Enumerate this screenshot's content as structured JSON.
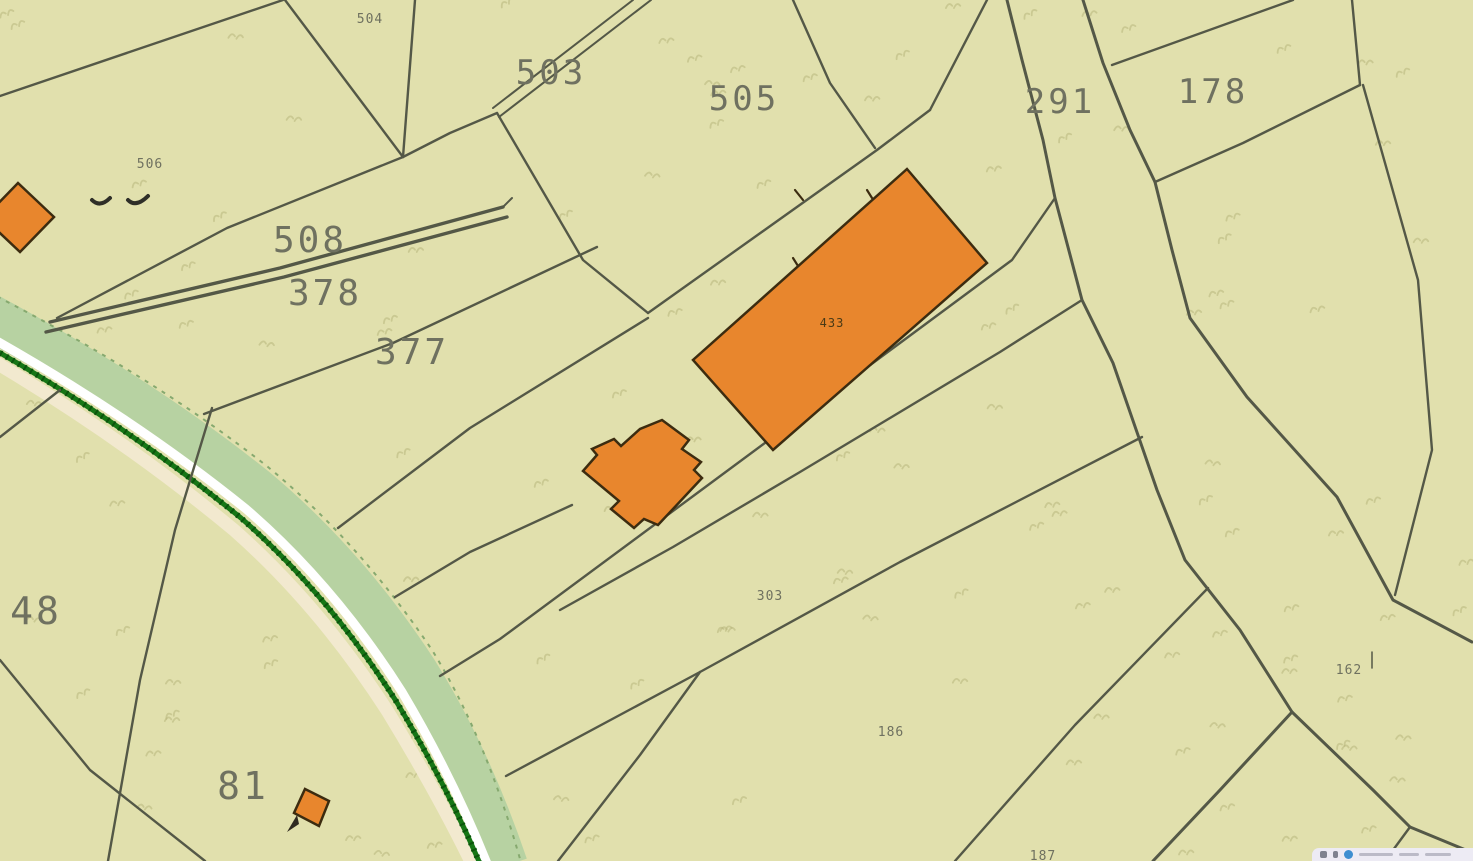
{
  "map": {
    "background_color": "#e1e0ad",
    "line_color": "#545847",
    "label_color": "#6f7160",
    "building_fill": "#e8862d",
    "building_stroke": "#3c2c10",
    "stream": {
      "layers": [
        {
          "name": "stream-core",
          "d": "M-12,316 Q140,398 255,490 Q345,565 415,672 Q468,757 505,866",
          "color": "#b7d2a2",
          "w": 46
        },
        {
          "name": "stream-bank",
          "d": "M-12,358 Q122,437 234,530 Q320,606 388,712 Q438,794 473,866",
          "color": "#f2e9cf",
          "w": 13
        },
        {
          "name": "stream-white-stripe",
          "d": "M-12,336 Q132,417 246,509 Q334,585 402,692 Q452,776 488,866",
          "color": "#ffffff",
          "w": 9
        },
        {
          "name": "stream-dark-edge",
          "d": "M-12,346 Q128,426 241,518 Q328,594 396,701 Q446,784 481,866",
          "color": "#167616",
          "w": 5
        },
        {
          "name": "stream-dark-stipple",
          "d": "M-12,346 Q128,426 241,518 Q328,594 396,701 Q446,784 481,866",
          "color": "#0b540c",
          "w": 6,
          "dash": "2,5"
        },
        {
          "name": "stream-ne-edge",
          "d": "M-12,292 Q150,374 268,467 Q360,543 432,650 Q486,737 522,866",
          "color": "#86a96f",
          "w": 2,
          "dash": "4,6"
        }
      ]
    },
    "boundaries": [
      {
        "pts": "0,96 283,0"
      },
      {
        "pts": "285,0 403,157"
      },
      {
        "pts": "403,157 450,133 497,113"
      },
      {
        "pts": "415,0 403,157"
      },
      {
        "pts": "403,157 227,228 57,318"
      },
      {
        "pts": "493,108 633,0",
        "w": 2
      },
      {
        "pts": "499,117 651,0",
        "w": 2
      },
      {
        "pts": "503,207 280,268 50,322",
        "w": 3.4
      },
      {
        "pts": "507,217 284,277 46,332",
        "w": 3.4
      },
      {
        "pts": "497,113 583,260 648,313"
      },
      {
        "pts": "648,313 877,150 930,110"
      },
      {
        "pts": "930,110 987,0"
      },
      {
        "pts": "793,0 830,83 875,148"
      },
      {
        "pts": "597,247 393,343 204,414"
      },
      {
        "pts": "648,318 470,428 338,528"
      },
      {
        "pts": "395,597 470,552 572,505"
      },
      {
        "pts": "560,610 673,547 800,472 1000,352 1082,300"
      },
      {
        "pts": "1055,198 1012,260 900,343 700,491 500,639 440,676"
      },
      {
        "pts": "506,776 700,672 900,562 1142,437"
      },
      {
        "pts": "558,861 640,755 700,672"
      },
      {
        "pts": "955,861 1075,725 1208,588"
      },
      {
        "pts": "1007,0 1022,60 1043,140 1055,198 1082,300 1113,363 1157,490 1185,560 1240,630 1292,712",
        "w": 3
      },
      {
        "pts": "1292,712 1220,790 1153,861",
        "w": 3
      },
      {
        "pts": "1292,712 1373,790 1410,827",
        "w": 3
      },
      {
        "pts": "1410,827 1473,853",
        "w": 3
      },
      {
        "pts": "1410,827 1385,861"
      },
      {
        "pts": "1083,0 1103,63 1130,130 1155,182",
        "w": 3
      },
      {
        "pts": "1155,182 1172,250 1190,318 1247,397 1337,497 1393,600 1472,642",
        "w": 3
      },
      {
        "pts": "1112,65 1293,0"
      },
      {
        "pts": "1352,0 1360,85"
      },
      {
        "pts": "1360,85 1243,143 1155,182"
      },
      {
        "pts": "1363,85 1418,280 1432,450 1395,595"
      },
      {
        "pts": "212,408 175,530 140,680 108,861"
      },
      {
        "pts": "0,660 90,770 205,861"
      },
      {
        "pts": "60,390 0,437"
      },
      {
        "pts": "503,207 512,198",
        "w": 2
      },
      {
        "pts": "1372,652 1372,668",
        "w": 1.5
      }
    ],
    "buildings": [
      {
        "name": "building-433",
        "path": "M907,169 L987,263 L773,450 L693,360 Z"
      },
      {
        "name": "building-farmstead",
        "path": "M662,420 L689,440 L682,449 L701,462 L694,470 L702,478 L658,525 L644,519 L634,528 L611,509 L619,501 L583,471 L597,455 L592,449 L614,439 L621,446 L640,429 Z"
      },
      {
        "name": "building-left-edge",
        "path": "M18,183 L54,217 L20,252 L-16,218 Z"
      },
      {
        "name": "building-81",
        "path": "M305,789 L329,801 L319,826 L294,813 Z"
      }
    ],
    "building_ticks": [
      {
        "pts": "798,266 793,258"
      },
      {
        "pts": "872,198 867,190"
      },
      {
        "pts": "795,190 803,200"
      }
    ],
    "decor_marks": [
      {
        "d": "M92,200 q8,8 18,-2",
        "w": 4
      },
      {
        "d": "M128,200 q8,8 20,-4",
        "w": 4
      },
      {
        "d": "M297,815 l-10,17 l12,-8 z",
        "fill": "#2f2a20",
        "w": 0
      }
    ],
    "labels": [
      {
        "text": "503",
        "x": 551,
        "y": 84,
        "fs": 34
      },
      {
        "text": "505",
        "x": 744,
        "y": 110,
        "fs": 34
      },
      {
        "text": "508",
        "x": 310,
        "y": 252,
        "fs": 36
      },
      {
        "text": "378",
        "x": 325,
        "y": 305,
        "fs": 36
      },
      {
        "text": "377",
        "x": 412,
        "y": 364,
        "fs": 36
      },
      {
        "text": "291",
        "x": 1060,
        "y": 113,
        "fs": 34
      },
      {
        "text": "178",
        "x": 1213,
        "y": 103,
        "fs": 34
      },
      {
        "text": "48",
        "x": 36,
        "y": 624,
        "fs": 38
      },
      {
        "text": "81",
        "x": 243,
        "y": 799,
        "fs": 38
      },
      {
        "text": "504",
        "x": 370,
        "y": 23,
        "fs": 13
      },
      {
        "text": "506",
        "x": 150,
        "y": 168,
        "fs": 13
      },
      {
        "text": "303",
        "x": 770,
        "y": 600,
        "fs": 13
      },
      {
        "text": "186",
        "x": 891,
        "y": 736,
        "fs": 13
      },
      {
        "text": "162",
        "x": 1349,
        "y": 674,
        "fs": 13
      },
      {
        "text": "187",
        "x": 1043,
        "y": 860,
        "fs": 13
      },
      {
        "text": "433",
        "x": 832,
        "y": 327,
        "fs": 12,
        "color": "#4a3a16"
      }
    ],
    "vegetation": {
      "seed": 12,
      "count": 130,
      "color": "#b4b277",
      "opacity": 0.5
    },
    "attribution": {
      "dot_color": "#3e8ed0",
      "bg": "#edebf4"
    }
  }
}
